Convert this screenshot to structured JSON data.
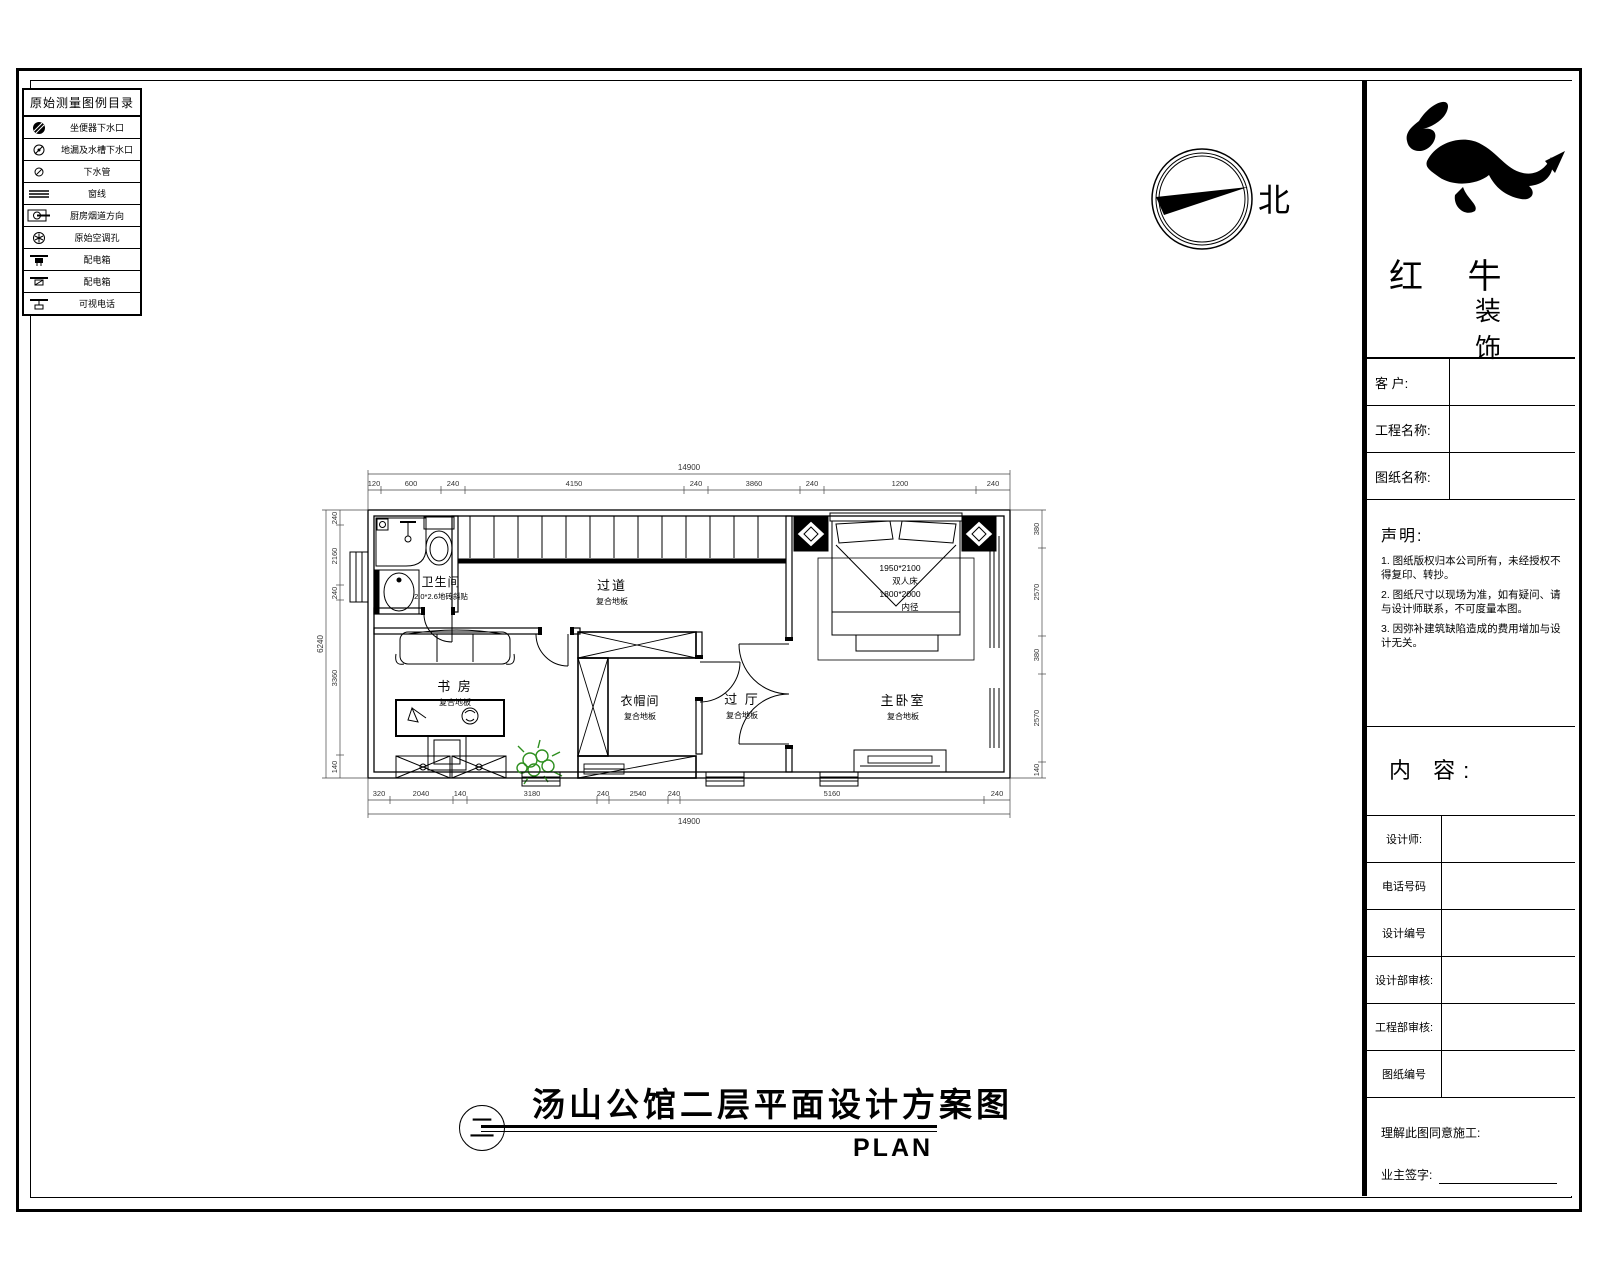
{
  "legend": {
    "title": "原始测量图例目录",
    "items": [
      {
        "icon": "toilet-drain-icon",
        "label": "坐便器下水口"
      },
      {
        "icon": "floor-drain-icon",
        "label": "地漏及水槽下水口"
      },
      {
        "icon": "pipe-icon",
        "label": "下水管"
      },
      {
        "icon": "window-line-icon",
        "label": "窗线"
      },
      {
        "icon": "flue-icon",
        "label": "厨房烟道方向"
      },
      {
        "icon": "ac-hole-icon",
        "label": "原始空调孔"
      },
      {
        "icon": "power-box-icon",
        "label": "配电箱"
      },
      {
        "icon": "power-box2-icon",
        "label": "配电箱"
      },
      {
        "icon": "videophone-icon",
        "label": "可视电话"
      }
    ]
  },
  "compass": {
    "north": "北"
  },
  "titleblock": {
    "brand1": "红 牛",
    "brand2": "装 饰",
    "fields_top": [
      {
        "label": "客  户:"
      },
      {
        "label": "工程名称:"
      },
      {
        "label": "图纸名称:"
      }
    ],
    "statement": {
      "title": "声明:",
      "notes": [
        "1. 图纸版权归本公司所有，未经授权不得复印、转抄。",
        "2. 图纸尺寸以现场为准，如有疑问、请与设计师联系，不可度量本图。",
        "3. 因弥补建筑缺陷造成的费用增加与设计无关。"
      ]
    },
    "content_label": "内 容:",
    "fields_bottom": [
      {
        "label": "设计师:"
      },
      {
        "label": "电话号码"
      },
      {
        "label": "设计编号"
      },
      {
        "label": "设计部审核:"
      },
      {
        "label": "工程部审核:"
      },
      {
        "label": "图纸编号"
      }
    ],
    "footer": {
      "agree": "理解此图同意施工:",
      "sign": "业主签字:"
    }
  },
  "plan": {
    "rooms": [
      {
        "name": "卫生间",
        "sub": "2.0*2.6地砖斜贴"
      },
      {
        "name": "过道",
        "sub": "复合地板"
      },
      {
        "name": "书 房",
        "sub": "复合地板"
      },
      {
        "name": "衣帽间",
        "sub": "复合地板"
      },
      {
        "name": "过 厅",
        "sub": "复合地板"
      },
      {
        "name": "主卧室",
        "sub": "复合地板"
      }
    ],
    "bed": [
      "1950*2100",
      "双人床",
      "1800*2000",
      "内径"
    ],
    "dims": {
      "top_total": "14900",
      "top": [
        "120",
        "600",
        "240",
        "4150",
        "240",
        "3860",
        "240",
        "1200",
        "240"
      ],
      "bottom": [
        "320",
        "2040",
        "140",
        "3180",
        "240",
        "2540",
        "240",
        "5160",
        "240"
      ],
      "bottom_total": "14900",
      "left": [
        "240",
        "2160",
        "240",
        "3360",
        "140"
      ],
      "left_total": "6240",
      "right": [
        "380",
        "2570",
        "380",
        "2570",
        "140"
      ]
    }
  },
  "footer": {
    "marker": "二",
    "title": "汤山公馆二层平面设计方案图",
    "plan_label": "PLAN"
  },
  "colors": {
    "line": "#000000",
    "dim": "#444444",
    "plant": "#2e8f1f"
  }
}
